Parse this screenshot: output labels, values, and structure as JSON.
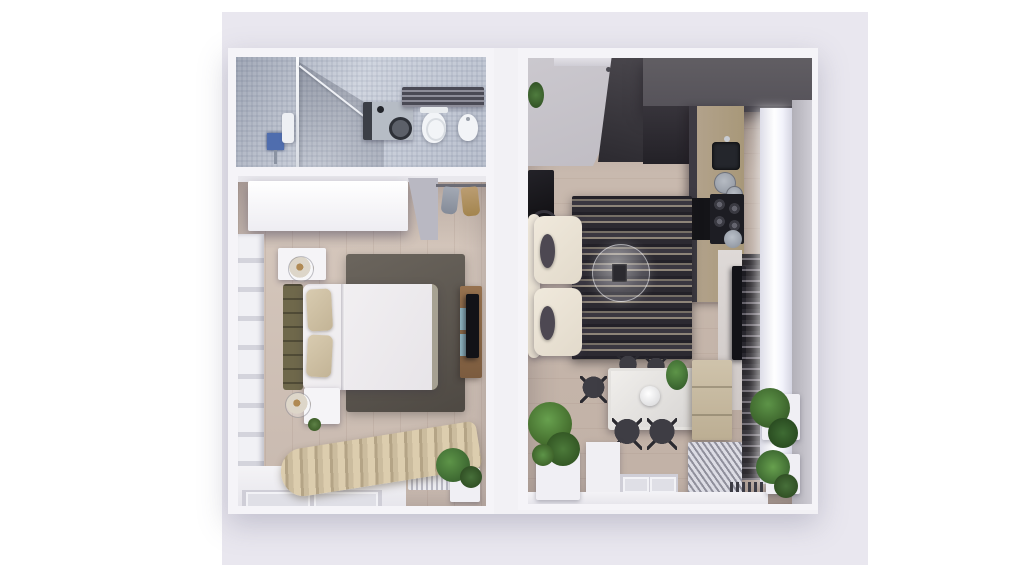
{
  "scene": {
    "type": "3d-floorplan-top-view-render",
    "description": "Top-down 3D render of a small apartment: left unit with bathroom and bedroom, right unit with combined living room and kitchen",
    "background_color": "#ffffff",
    "mat_color": "#e9e7ef",
    "wall_color": "#f5f4f8"
  },
  "rooms": {
    "bathroom": {
      "label": "Bathroom",
      "floor_color": "#c7cdd9",
      "items": [
        "shower enclosure with glass partition",
        "shower mixer",
        "wall shelf",
        "washing machine",
        "toilet",
        "bidet",
        "towel radiator"
      ]
    },
    "bedroom": {
      "label": "Bedroom",
      "floor_color": "#cfc1b6",
      "items": [
        "white wardrobe",
        "clothes rail with garments",
        "padded wall panels",
        "double bed with olive headboard",
        "beige pillows",
        "two round nightstand lamps",
        "two nightstands",
        "dark gray rug",
        "wood tv console with teal drawers",
        "tv",
        "beige curtains",
        "window sill",
        "white radiator",
        "potted plant"
      ]
    },
    "living_kitchen": {
      "label": "Living room with kitchen",
      "floor_color": "#c6b6ab",
      "items": [
        "entry door",
        "tall charcoal wardrobe",
        "dark gray upper kitchen cabinets",
        "pendant lights",
        "kitchen counter",
        "sink",
        "gray bowls",
        "gas hob",
        "built-in oven",
        "kettle",
        "cream two-seat sofa",
        "dark lumbar pillows",
        "striped rug",
        "round glass coffee table",
        "black side table",
        "floor lamp",
        "media panel with tv",
        "shelf column",
        "bright window wall",
        "white dining table",
        "fruit bowl",
        "five dark wire chairs",
        "beige sideboard",
        "diagonal-ribbed radiator",
        "finned radiator",
        "window frames",
        "green plants in white planters"
      ]
    }
  },
  "palette": {
    "tile_blue_gray": "#c7cdd9",
    "wood_light": "#cfc1b6",
    "rug_dark": "#55504a",
    "olive_headboard": "#6f684b",
    "pillow_beige": "#cfc1a4",
    "curtain_beige": "#cbbc9e",
    "charcoal": "#2c2a30",
    "cabinet_gray": "#5b585e",
    "sofa_cream": "#ece4d6",
    "teal_drawer": "#8fb3c0",
    "tv_black": "#121217",
    "plant_green": "#4c7a3a",
    "window_light": "#ffffff",
    "wall_lavender": "#e9e7ef"
  }
}
